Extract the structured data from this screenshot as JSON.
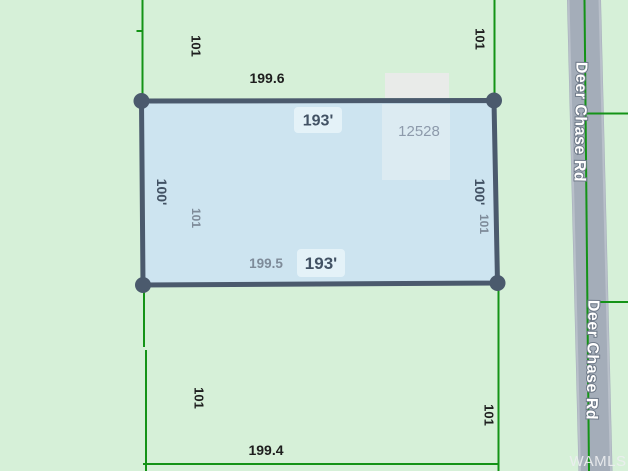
{
  "map": {
    "type": "plat-parcel-map",
    "parcel_number": "12528",
    "road_name": "Deer Chase Rd",
    "watermark": "WAMLS",
    "dimensions": {
      "outer_top": "199.6",
      "outer_bottom": "199.4",
      "inner_bottom": "199.5",
      "lot_width_top": "193'",
      "lot_width_bottom": "193'",
      "lot_depth_left": "100'",
      "lot_depth_right": "100'",
      "block_side_nw": "101",
      "block_side_ne": "101",
      "block_side_sw": "101",
      "block_side_se": "101",
      "lot_side_left": "101",
      "lot_side_right": "101"
    },
    "colors": {
      "background_green": "#d6f0d8",
      "boundary_green": "#149317",
      "parcel_fill": "#cde4f0",
      "parcel_border": "#4b5a6d",
      "corner_marker": "#4b5a6d",
      "road_fill": "#a4adb9",
      "road_edge": "#b9c0ca",
      "building_fill": "#e9ebe9",
      "dim_text_black": "#1e1e1e",
      "dim_text_slate": "#425264",
      "dim_text_gray": "#7e8b99",
      "parcel_number_text": "#8d9aab",
      "road_text": "#ffffff",
      "road_text_outline": "#6e7988"
    }
  }
}
